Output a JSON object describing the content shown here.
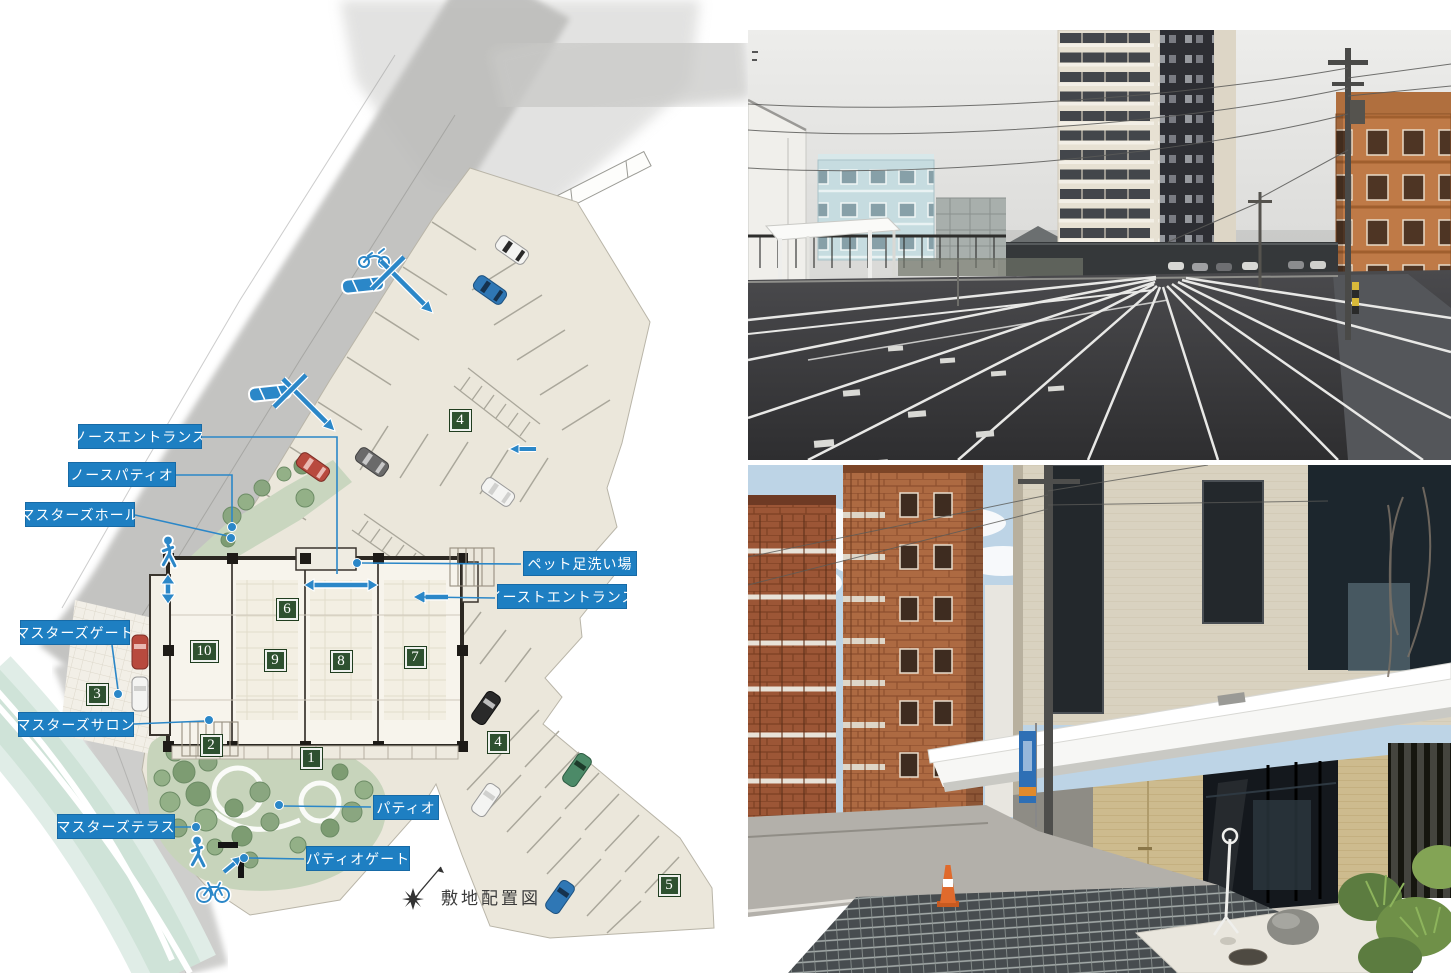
{
  "site_plan": {
    "caption": "敷地配置図",
    "callouts": [
      {
        "id": "north-entrance",
        "text": "ノースエントランス",
        "box": {
          "x": 78,
          "y": 424,
          "w": 124
        },
        "line": [
          [
            202,
            437
          ],
          [
            337,
            437
          ],
          [
            337,
            574
          ]
        ],
        "dot": null,
        "arrow": null
      },
      {
        "id": "north-patio",
        "text": "ノースパティオ",
        "box": {
          "x": 68,
          "y": 462,
          "w": 108
        },
        "line": [
          [
            176,
            475
          ],
          [
            232,
            475
          ],
          [
            232,
            524
          ]
        ],
        "dot": [
          232,
          527
        ],
        "arrow": null
      },
      {
        "id": "masters-hall",
        "text": "マスターズホール",
        "box": {
          "x": 25,
          "y": 502,
          "w": 110
        },
        "line": [
          [
            135,
            515
          ],
          [
            228,
            536
          ]
        ],
        "dot": [
          231,
          538
        ],
        "arrow": null
      },
      {
        "id": "masters-gate",
        "text": "マスターズゲート",
        "box": {
          "x": 20,
          "y": 620,
          "w": 110
        },
        "line": [
          [
            112,
            645
          ],
          [
            118,
            690
          ]
        ],
        "dot": [
          118,
          694
        ],
        "arrow": null
      },
      {
        "id": "masters-salon",
        "text": "マスターズサロン",
        "box": {
          "x": 18,
          "y": 712,
          "w": 116
        },
        "line": [
          [
            134,
            724
          ],
          [
            205,
            721
          ]
        ],
        "dot": [
          209,
          720
        ],
        "arrow": null
      },
      {
        "id": "masters-terrace",
        "text": "マスターズテラス",
        "box": {
          "x": 57,
          "y": 814,
          "w": 118
        },
        "line": [
          [
            175,
            827
          ],
          [
            192,
            827
          ]
        ],
        "dot": [
          196,
          827
        ],
        "arrow": null
      },
      {
        "id": "patio",
        "text": "パティオ",
        "box": {
          "x": 373,
          "y": 795,
          "w": 66
        },
        "line": [
          [
            371,
            807
          ],
          [
            283,
            806
          ]
        ],
        "dot": [
          279,
          805
        ],
        "arrow": null
      },
      {
        "id": "patio-gate",
        "text": "パティオゲート",
        "box": {
          "x": 306,
          "y": 846,
          "w": 104
        },
        "line": [
          [
            304,
            859
          ],
          [
            248,
            858
          ]
        ],
        "dot": [
          244,
          858
        ],
        "arrow": null
      },
      {
        "id": "pet-foot-wash",
        "text": "ペット足洗い場",
        "box": {
          "x": 523,
          "y": 551,
          "w": 114
        },
        "line": [
          [
            521,
            564
          ],
          [
            361,
            563
          ]
        ],
        "dot": [
          357,
          563
        ],
        "arrow": null
      },
      {
        "id": "east-entrance",
        "text": "イーストエントランス",
        "box": {
          "x": 497,
          "y": 584,
          "w": 130
        },
        "line": [
          [
            495,
            598
          ],
          [
            422,
            597
          ]
        ],
        "dot": null,
        "arrow": [
          414,
          597
        ]
      }
    ],
    "markers": [
      {
        "value": "4",
        "x": 459,
        "y": 419
      },
      {
        "value": "4",
        "x": 497,
        "y": 741
      },
      {
        "value": "5",
        "x": 668,
        "y": 884
      },
      {
        "value": "3",
        "x": 96,
        "y": 693
      },
      {
        "value": "2",
        "x": 210,
        "y": 744
      },
      {
        "value": "1",
        "x": 310,
        "y": 757
      },
      {
        "value": "6",
        "x": 286,
        "y": 608
      },
      {
        "value": "9",
        "x": 274,
        "y": 659
      },
      {
        "value": "8",
        "x": 340,
        "y": 660
      },
      {
        "value": "7",
        "x": 414,
        "y": 656
      },
      {
        "value": "10",
        "x": 203,
        "y": 650
      }
    ],
    "caption_pos": {
      "x": 441,
      "y": 884
    },
    "icons": [
      "pedestrian-icon",
      "bicycle-icon",
      "car-icon",
      "motorcycle-icon",
      "entrance-arrow-icon",
      "north-compass-icon"
    ],
    "colors": {
      "label_blue": "#1e7fc2",
      "icon_blue": "#2b87c8",
      "marker_green": "#2e5130",
      "site_cream": "#ebe7db",
      "green_area": "#c7d4bb",
      "river": "#cfe3d8"
    }
  },
  "photos": [
    {
      "id": "parking-lot-photo"
    },
    {
      "id": "entrance-photo"
    }
  ]
}
